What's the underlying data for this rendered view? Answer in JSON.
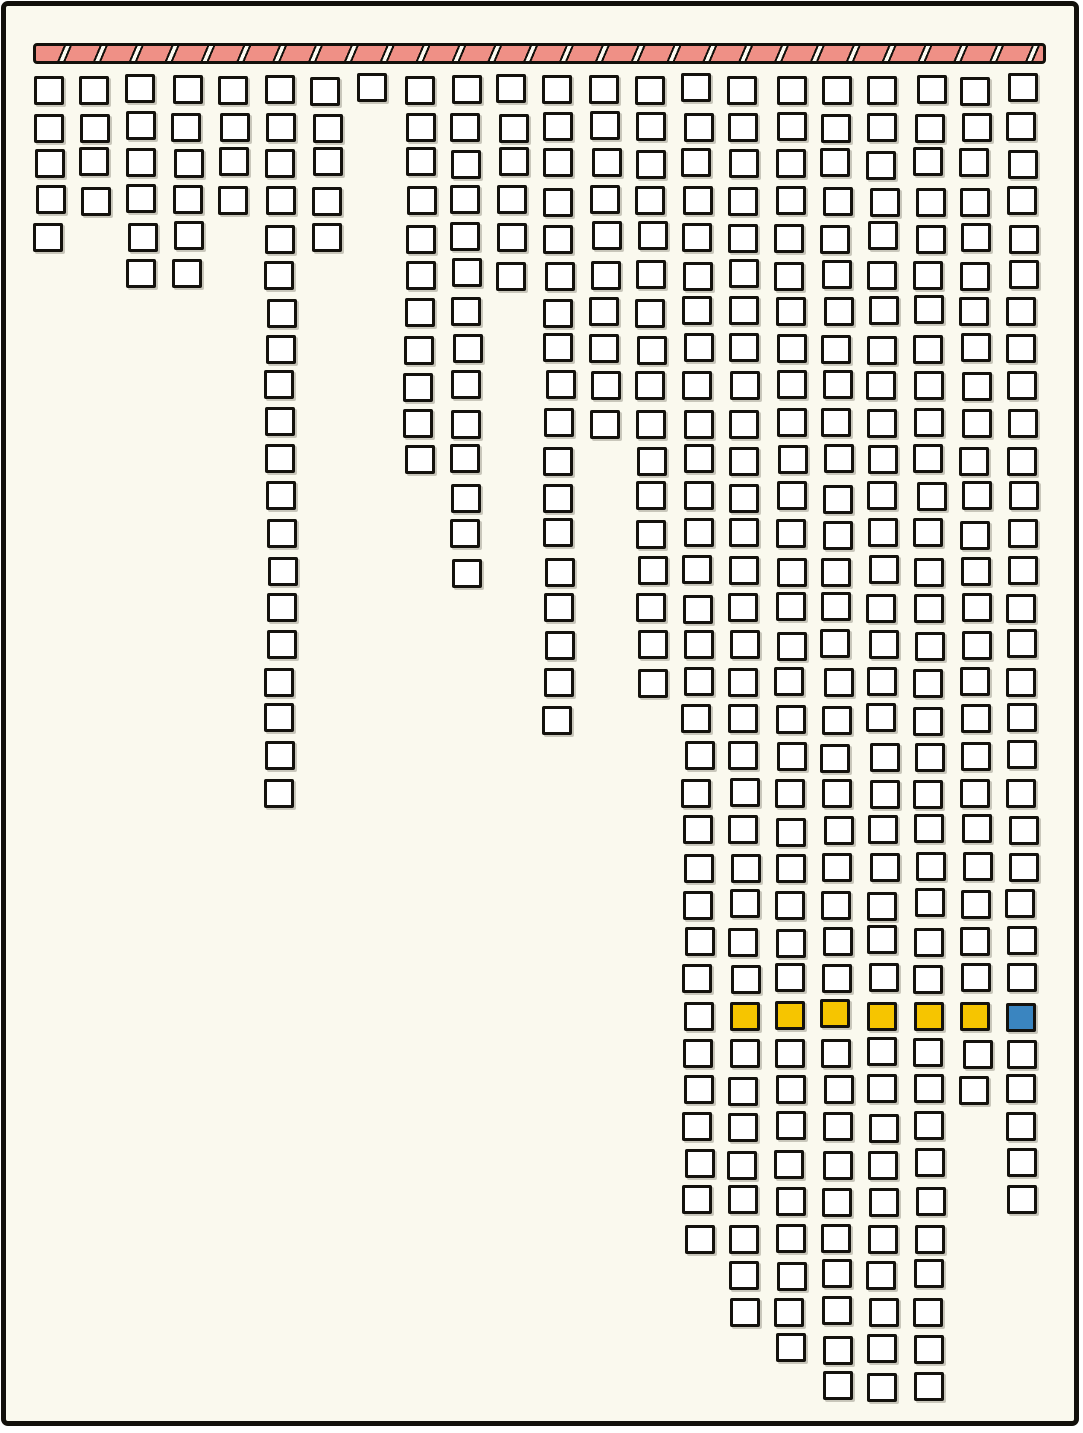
{
  "canvas": {
    "width_px": 1083,
    "height_px": 1433,
    "outer_background": "#ffffff",
    "paper_color": "#faf9ee",
    "frame_color": "#12100b"
  },
  "header_bar": {
    "style": "hatched-striped-bar",
    "fill_color": "#ef9086",
    "outline_color": "#12100b",
    "gap_color": "#fcfbf2"
  },
  "palette": {
    "cell_white": "#ffffff",
    "cell_border": "#14120d",
    "yellow": "#f6c500",
    "blue": "#3a85c0",
    "salmon": "#ef9086"
  },
  "chart_data": {
    "type": "waffle",
    "title": "",
    "description": "Hand-drawn waffle/icicle chart: 22 columns of outlined squares hang downward from a striped header bar; column lengths vary; row 26 is highlighted with six yellow squares (columns 16-21) and one blue square (column 22).",
    "columns": 22,
    "max_rows": 36,
    "column_heights": [
      5,
      4,
      6,
      6,
      4,
      20,
      5,
      1,
      11,
      14,
      6,
      18,
      10,
      17,
      32,
      34,
      35,
      36,
      36,
      36,
      28,
      31
    ],
    "total_squares": 395,
    "highlight_row": 26,
    "highlights": [
      {
        "col": 16,
        "row": 26,
        "color": "yellow"
      },
      {
        "col": 17,
        "row": 26,
        "color": "yellow"
      },
      {
        "col": 18,
        "row": 26,
        "color": "yellow"
      },
      {
        "col": 19,
        "row": 26,
        "color": "yellow"
      },
      {
        "col": 20,
        "row": 26,
        "color": "yellow"
      },
      {
        "col": 21,
        "row": 26,
        "color": "yellow"
      },
      {
        "col": 22,
        "row": 26,
        "color": "blue"
      }
    ],
    "grid_on": false,
    "legend": "none",
    "axis_labels": "none"
  }
}
